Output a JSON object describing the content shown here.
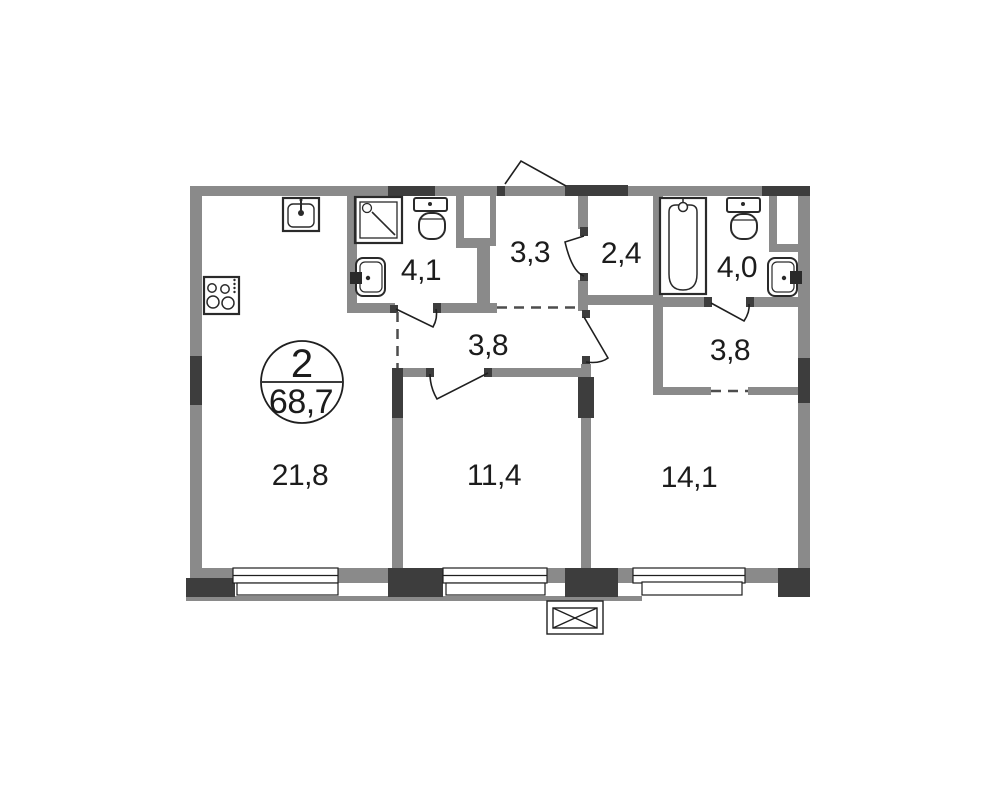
{
  "floor_plan": {
    "badge": {
      "rooms_count": "2",
      "total_area": "68,7"
    },
    "rooms": [
      {
        "id": "kitchen-living-room",
        "area": "21,8"
      },
      {
        "id": "bathroom-shower",
        "area": "4,1"
      },
      {
        "id": "entrance-hall",
        "area": "3,3"
      },
      {
        "id": "wardrobe",
        "area": "2,4"
      },
      {
        "id": "bathroom-tub",
        "area": "4,0"
      },
      {
        "id": "corridor",
        "area": "3,8"
      },
      {
        "id": "back-hall",
        "area": "3,8"
      },
      {
        "id": "bedroom-small",
        "area": "11,4"
      },
      {
        "id": "bedroom-large",
        "area": "14,1"
      }
    ],
    "icons": {
      "kitchen_sink": "sink-icon",
      "stove": "stove-icon",
      "shower": "shower-cabin-icon",
      "toilet_1": "toilet-icon",
      "washbasin_1": "washbasin-icon",
      "bathtub": "bathtub-icon",
      "toilet_2": "toilet-icon",
      "washbasin_2": "washbasin-icon",
      "vent": "ventilation-box-icon"
    },
    "colors": {
      "wall": "#8a8a8a",
      "wall_dark": "#3d3d3d",
      "outline": "#1f1f1f",
      "background": "#ffffff"
    }
  }
}
